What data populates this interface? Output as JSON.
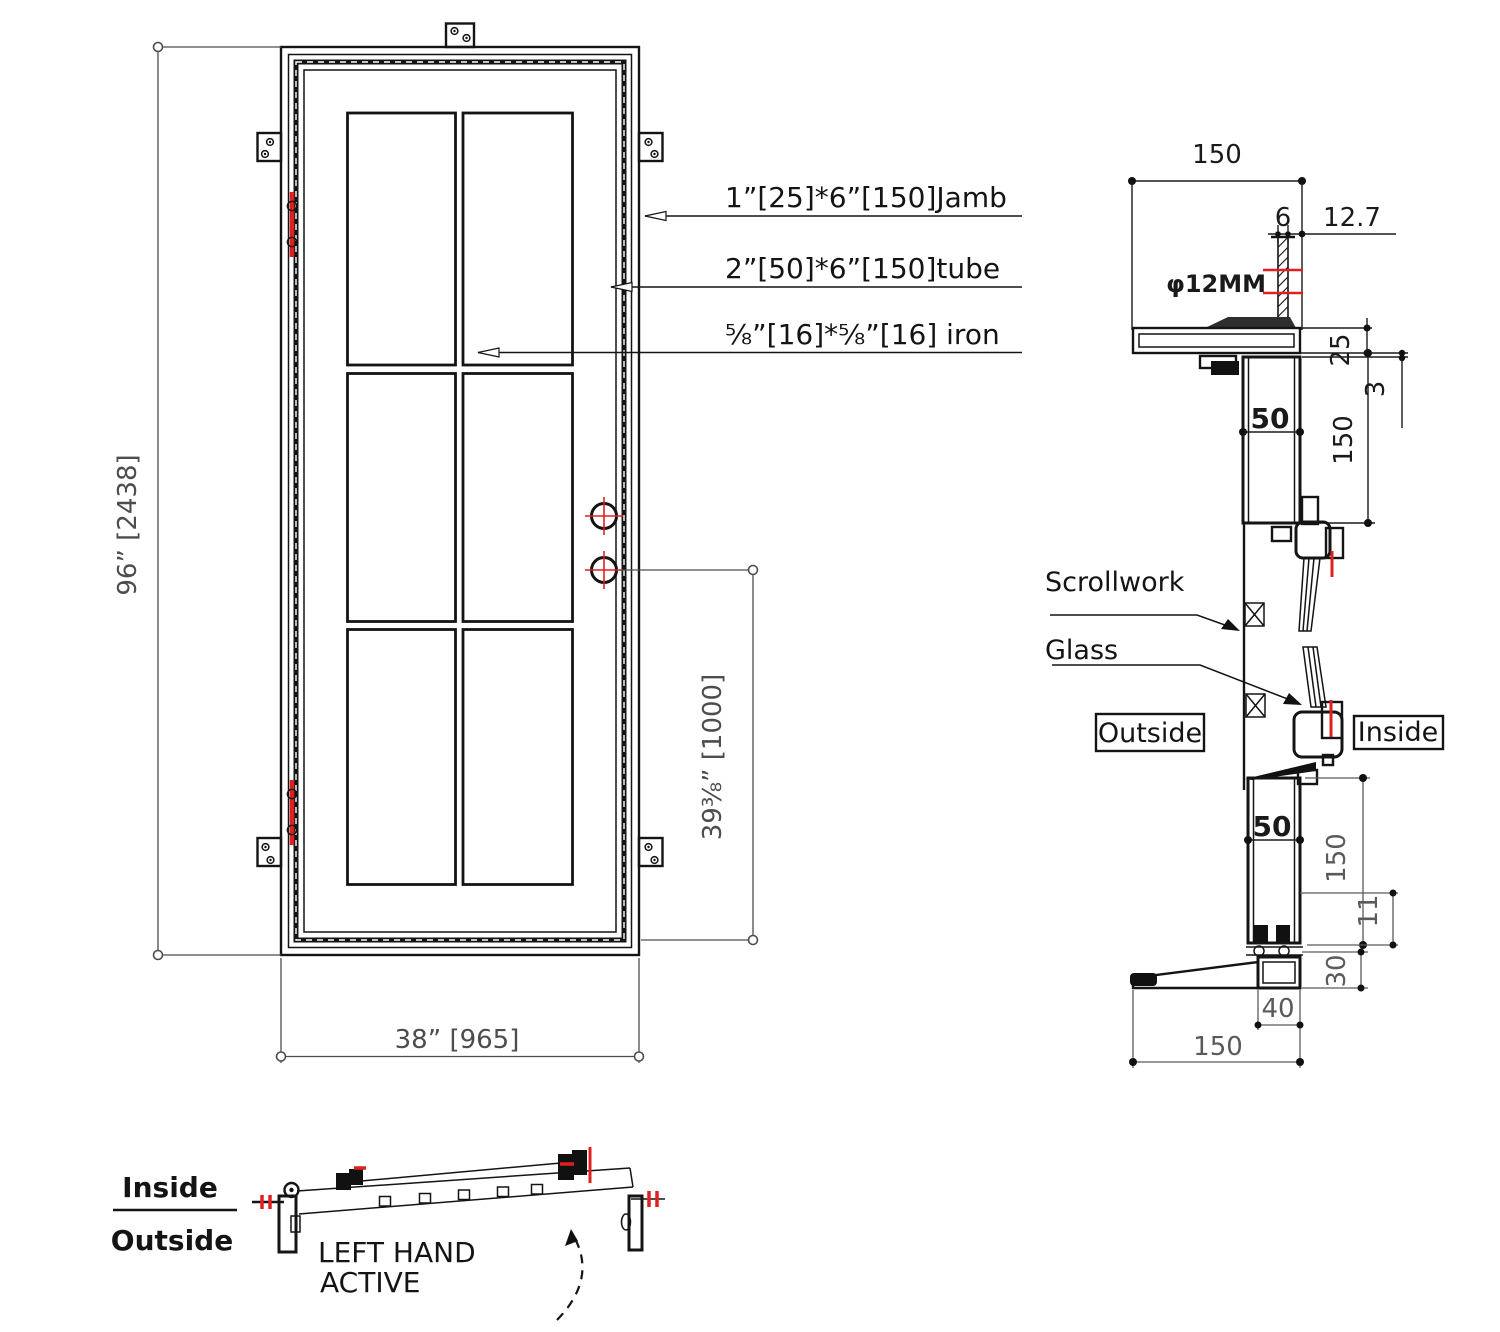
{
  "elevation": {
    "dim_height": "96” [2438]",
    "dim_width": "38” [965]",
    "dim_handle": "39⅜” [1000]",
    "callout_jamb": "1”[25]*6”[150]Jamb",
    "callout_tube": "2”[50]*6”[150]tube",
    "callout_iron": "⅝”[16]*⅝”[16] iron"
  },
  "section": {
    "label_scrollwork": "Scrollwork",
    "label_glass": "Glass",
    "label_outside": "Outside",
    "label_inside": "Inside",
    "dim_jamb_width": "150",
    "dim_anchor_w": "6",
    "dim_anchor_offset": "12.7",
    "dim_anchor_dia": "φ12MM",
    "dim_jamb_thk": "25",
    "dim_gap": "3",
    "dim_head_depth": "150",
    "dim_head_tube": "50",
    "dim_bottom_tube": "50",
    "dim_bottom_depth": "150",
    "dim_sweep": "11",
    "dim_threshold_h": "30",
    "dim_threshold_w": "40",
    "dim_sill": "150"
  },
  "plan": {
    "label_inside": "Inside",
    "label_outside": "Outside",
    "handing_line1": "LEFT HAND",
    "handing_line2": "ACTIVE"
  },
  "colors": {
    "line": "#141414",
    "dim_text": "#4d4d4d",
    "accent": "#e02020"
  }
}
